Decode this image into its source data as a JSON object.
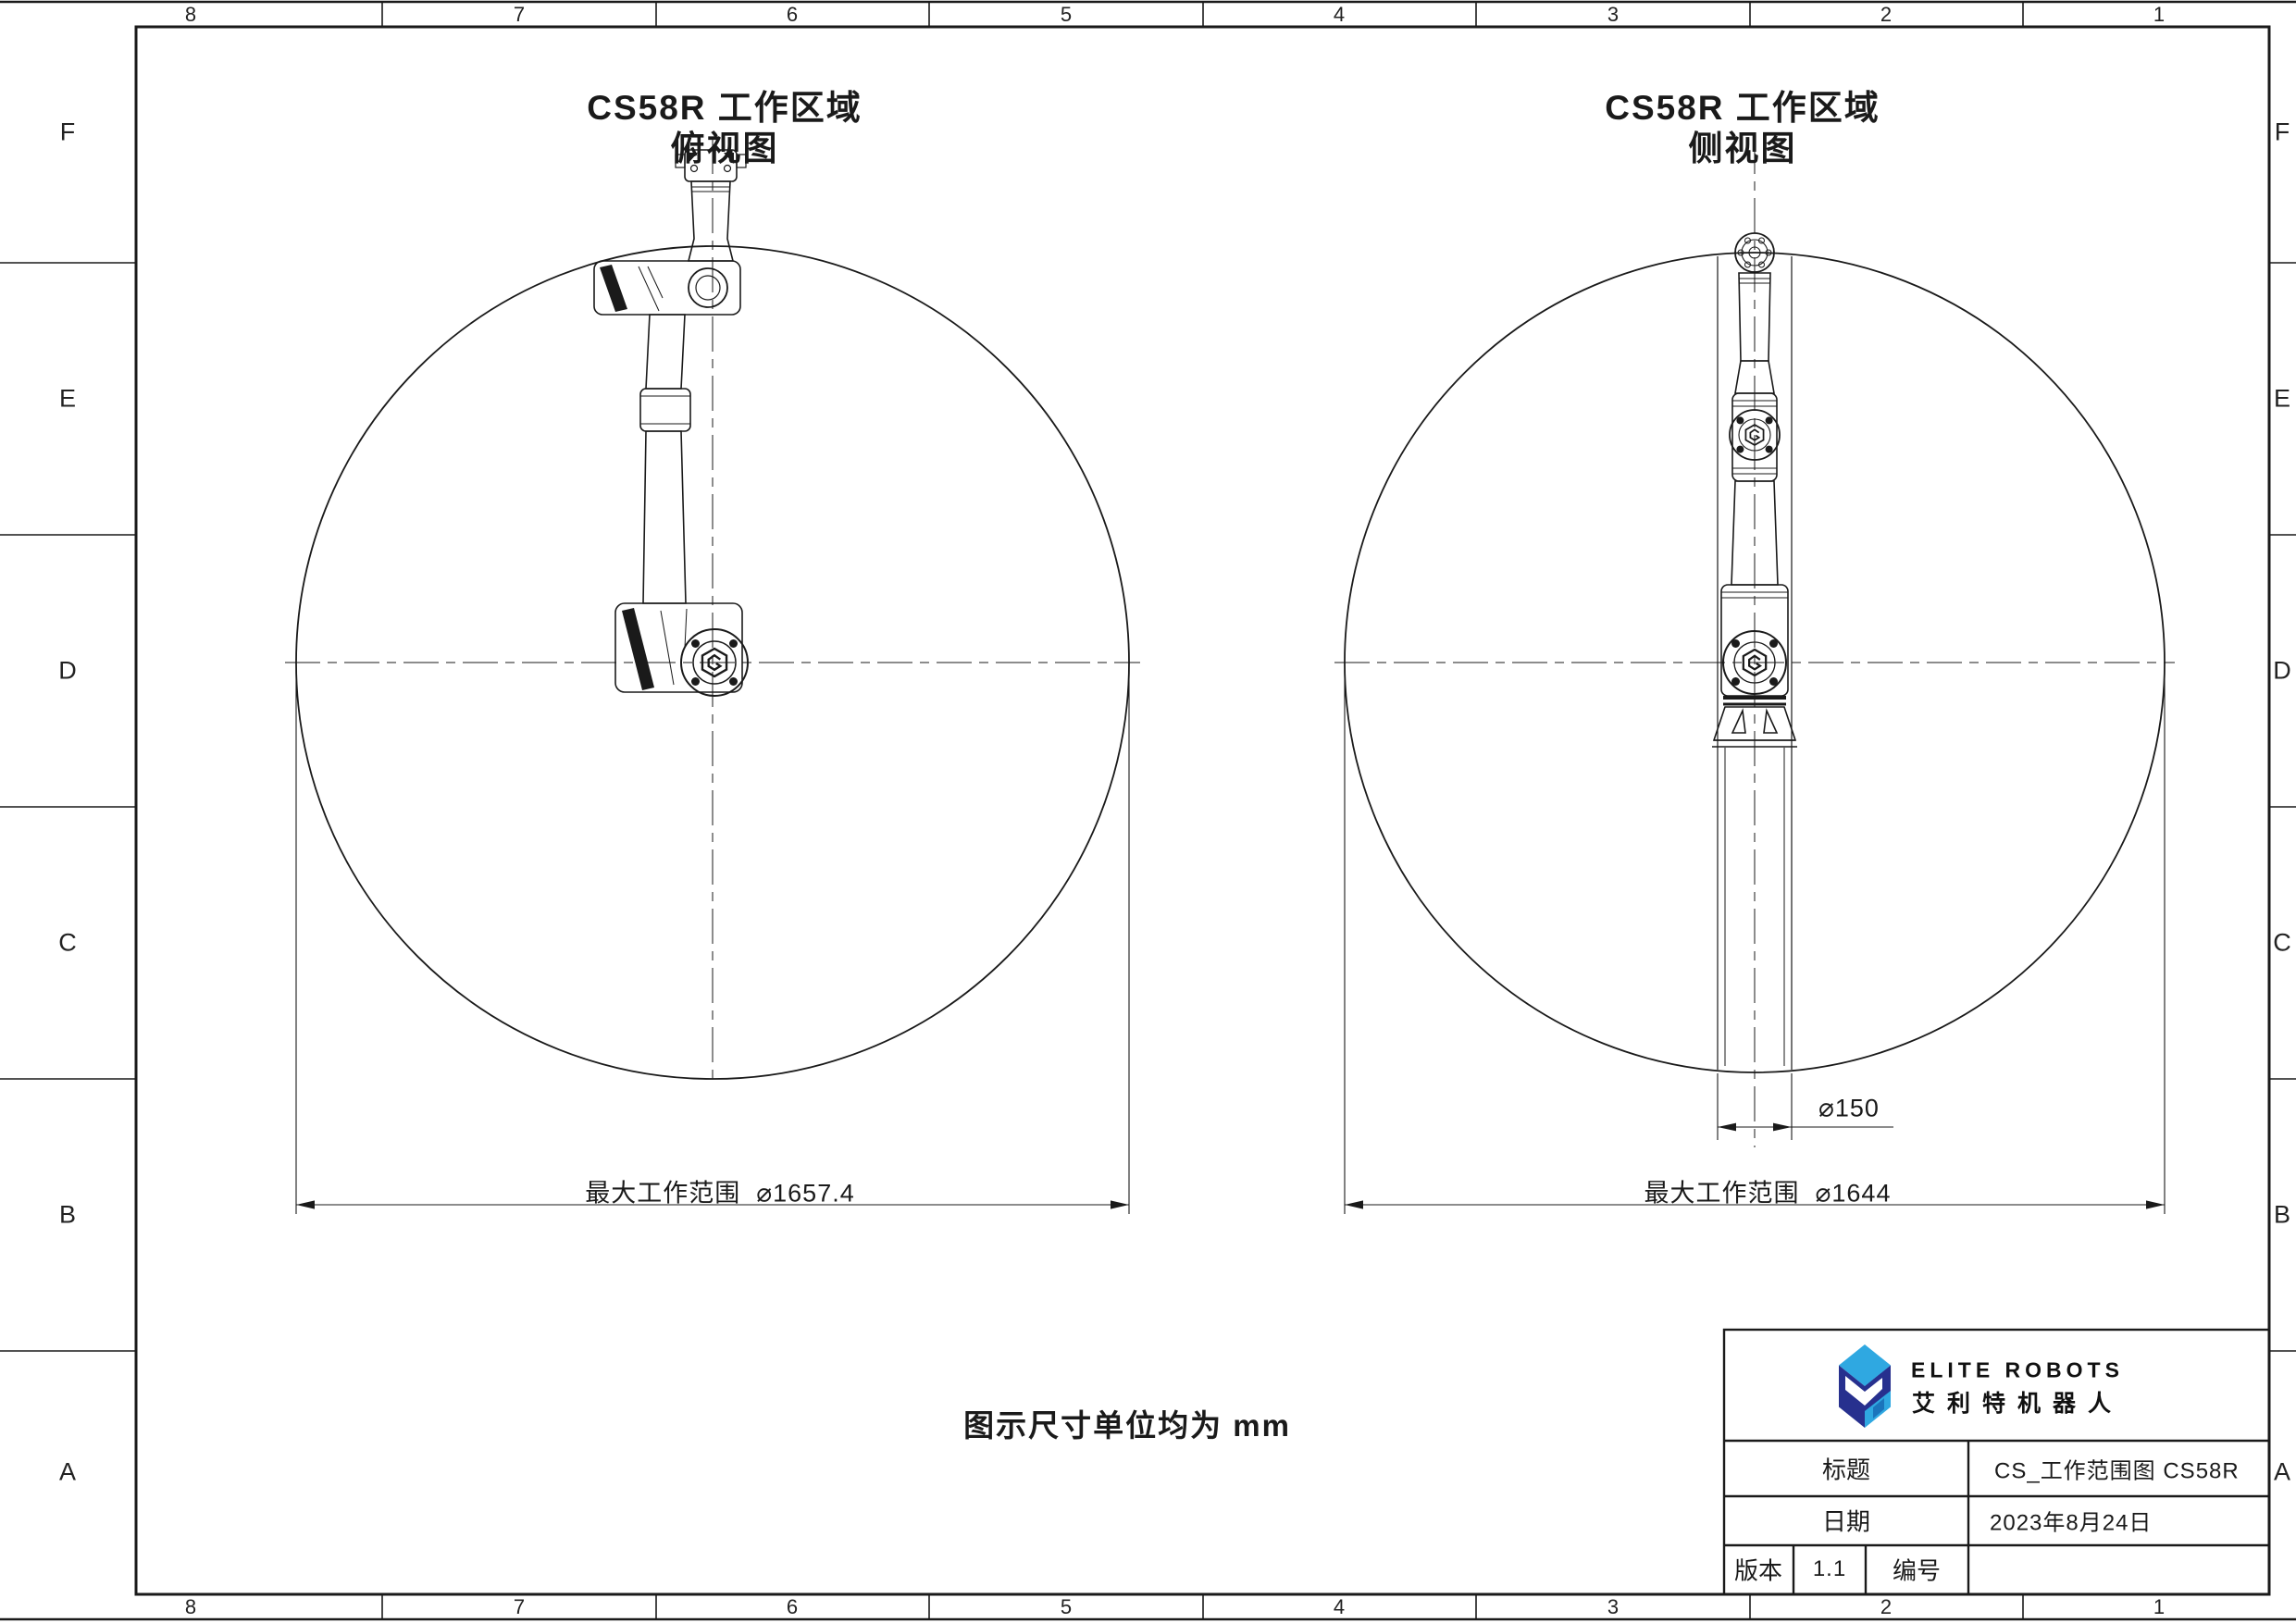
{
  "border": {
    "cols": [
      "8",
      "7",
      "6",
      "5",
      "4",
      "3",
      "2",
      "1"
    ],
    "rows": [
      "F",
      "E",
      "D",
      "C",
      "B",
      "A"
    ]
  },
  "views": {
    "top": {
      "title": "CS58R 工作区域",
      "subtitle": "俯视图",
      "dim_label": "最大工作范围",
      "dim_symbol": "⌀",
      "dim_value": "1657.4"
    },
    "side": {
      "title": "CS58R 工作区域",
      "subtitle": "侧视图",
      "dim_label": "最大工作范围",
      "dim_symbol": "⌀",
      "dim_value": "1644",
      "base_dim_symbol": "⌀",
      "base_dim_value": "150"
    }
  },
  "note": "图示尺寸单位均为 mm",
  "title_block": {
    "brand_en": "ELITE ROBOTS",
    "brand_cn": "艾利特机器人",
    "title_label": "标题",
    "title_value": "CS_工作范围图 CS58R",
    "date_label": "日期",
    "date_value": "2023年8月24日",
    "version_label": "版本",
    "version_value": "1.1",
    "number_label": "编号",
    "number_value": ""
  },
  "colors": {
    "line": "#1a1a1a",
    "logo_light_blue": "#2FA8E1",
    "logo_dark_blue": "#27308E",
    "logo_mid_blue": "#1B75BC"
  }
}
